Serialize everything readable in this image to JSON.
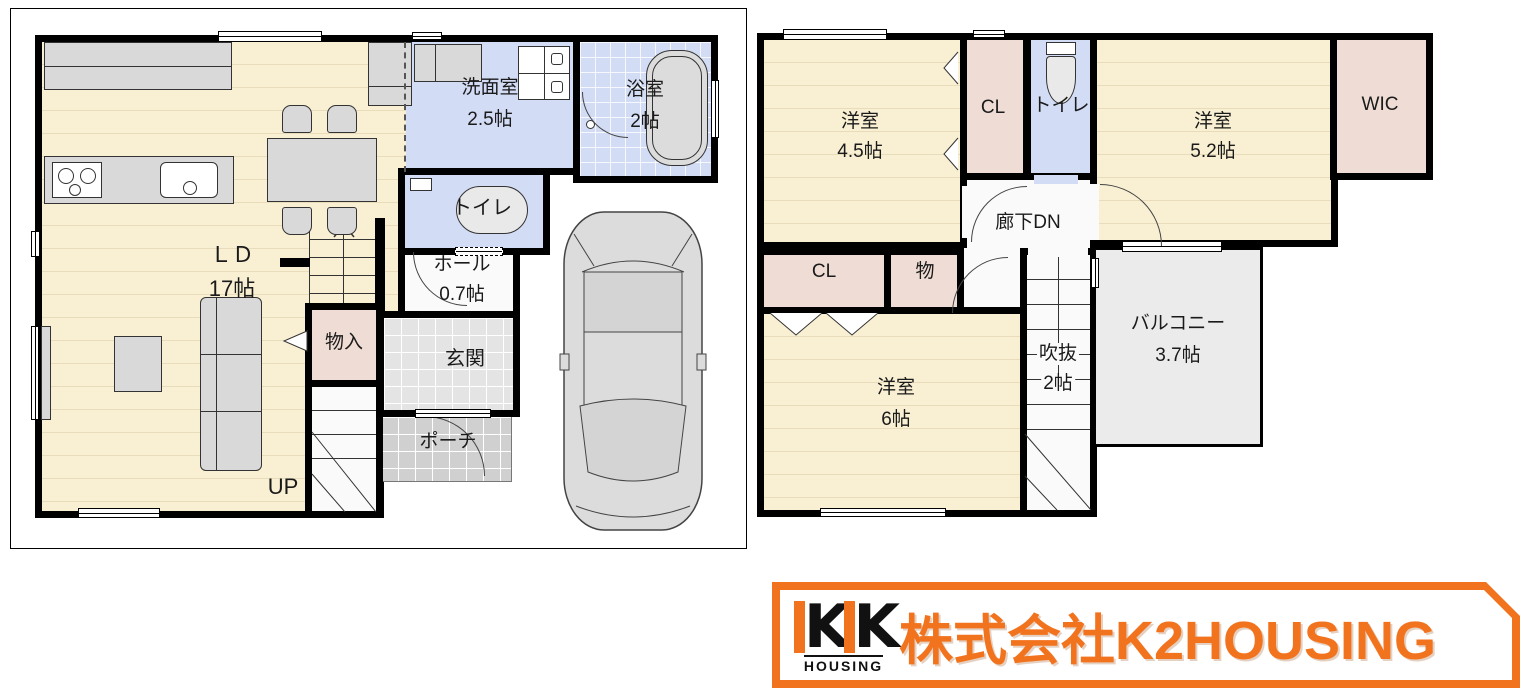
{
  "panel_1f": {
    "ld": {
      "name": "ＬＤ",
      "size": "17帖"
    },
    "senmen": {
      "name": "洗面室",
      "size": "2.5帖"
    },
    "bath": {
      "name": "浴室",
      "size": "2帖"
    },
    "toilet": {
      "name": "トイレ"
    },
    "hall": {
      "name": "ホール",
      "size": "0.7帖"
    },
    "monoire": {
      "name": "物入"
    },
    "genkan": {
      "name": "玄関"
    },
    "porch": {
      "name": "ポーチ"
    },
    "stairs_label": "UP"
  },
  "panel_2f": {
    "room_45": {
      "name": "洋室",
      "size": "4.5帖"
    },
    "cl_top": {
      "name": "CL"
    },
    "toilet": {
      "name": "トイレ"
    },
    "room_52": {
      "name": "洋室",
      "size": "5.2帖"
    },
    "wic": {
      "name": "WIC"
    },
    "corridor": {
      "name": "廊下"
    },
    "stairs_label": "DN",
    "cl_bottom": {
      "name": "CL"
    },
    "mono": {
      "name": "物"
    },
    "room_6": {
      "name": "洋室",
      "size": "6帖"
    },
    "void": {
      "name": "吹抜",
      "size": "2帖"
    },
    "balcony": {
      "name": "バルコニー",
      "size": "3.7帖"
    }
  },
  "logo": {
    "mark_letter_1": "K",
    "mark_letter_2": "K",
    "mark_sub": "HOUSING",
    "company": "株式会社K2HOUSING"
  },
  "colors": {
    "brand_orange": "#F2731D",
    "floor_cream": "#F9EFD3",
    "water_blue": "#D3DCF5",
    "closet_pink": "#EFDDD5",
    "entry_tile": "#E4E4E4",
    "porch_gray": "#D0D0D0",
    "balcony_gray": "#EBEBEB",
    "wall_black": "#000000"
  }
}
